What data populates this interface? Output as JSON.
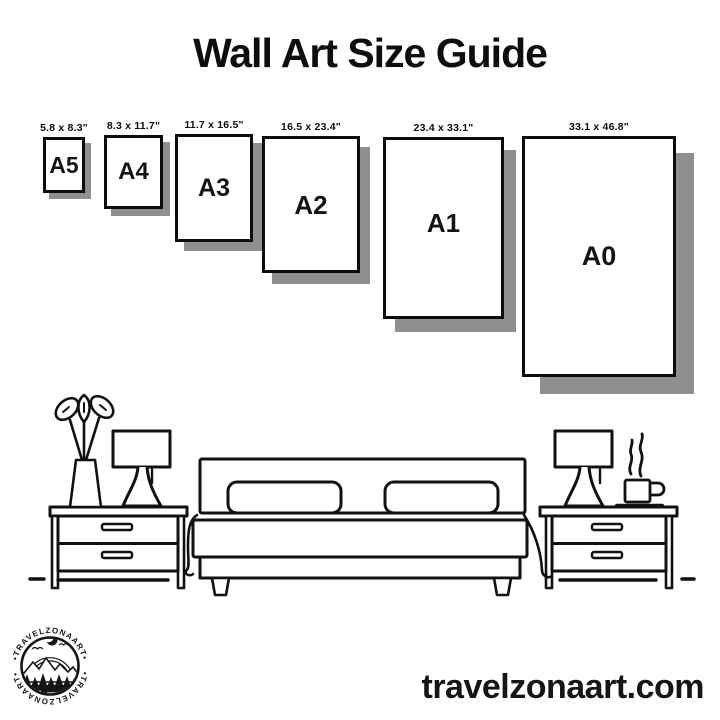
{
  "title": "Wall Art Size Guide",
  "sizes": [
    {
      "name": "A5",
      "dimensions": "5.8 x 8.3\""
    },
    {
      "name": "A4",
      "dimensions": "8.3 x 11.7\""
    },
    {
      "name": "A3",
      "dimensions": "11.7 x 16.5\""
    },
    {
      "name": "A2",
      "dimensions": "16.5 x 23.4\""
    },
    {
      "name": "A1",
      "dimensions": "23.4 x 33.1\""
    },
    {
      "name": "A0",
      "dimensions": "33.1 x 46.8\""
    }
  ],
  "illustration": {
    "scene": "bedroom",
    "items": [
      "potted-plant",
      "table-lamp-left",
      "nightstand-left",
      "double-bed-with-pillows",
      "nightstand-right",
      "table-lamp-right",
      "steaming-coffee-cup"
    ]
  },
  "logo": {
    "arc_text_top": "•TRAVELZONAART•",
    "arc_text_bottom": "•TRAVELZONAART•"
  },
  "footer": {
    "website": "travelzonaart.com"
  },
  "colors": {
    "ink": "#0c0c0c",
    "paper_shadow": "#8f8f8f",
    "background": "#ffffff"
  }
}
